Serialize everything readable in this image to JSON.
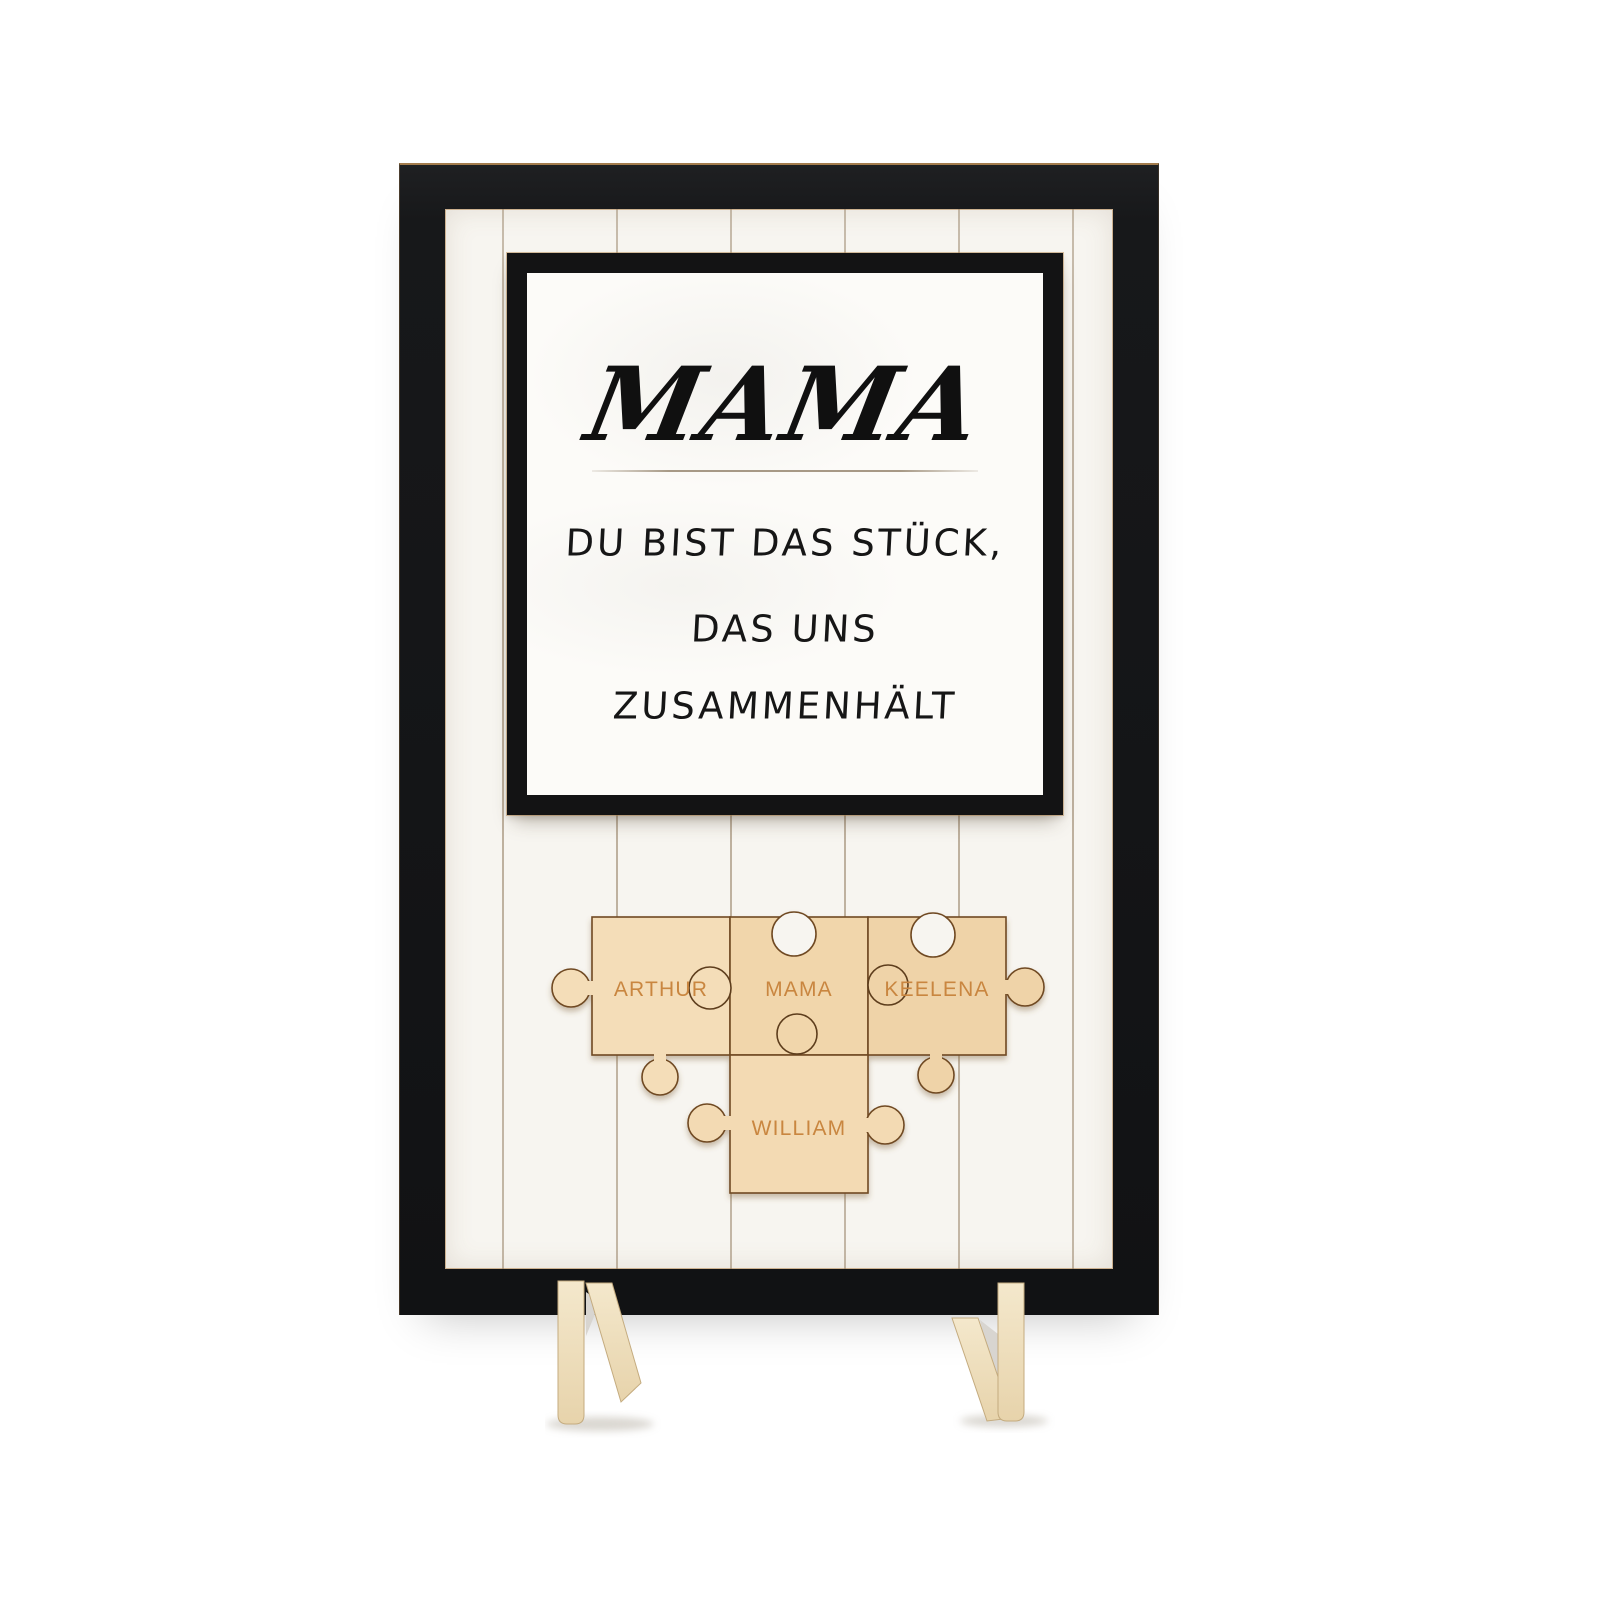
{
  "sign": {
    "title": "MAMA",
    "message_lines": [
      "DU BIST DAS STÜCK,",
      "DAS UNS",
      "ZUSAMMENHÄLT"
    ]
  },
  "puzzle": {
    "pieces": [
      {
        "name": "ARTHUR"
      },
      {
        "name": "MAMA"
      },
      {
        "name": "KEELENA"
      },
      {
        "name": "WILLIAM"
      }
    ]
  },
  "colors": {
    "frame_black": "#17181a",
    "panel_white": "#f7f5f0",
    "card_white": "#fcfbf8",
    "wood_light": "#f2d9ae",
    "wood_outline": "#6f4a24",
    "engraving": "#c9863f",
    "plywood_edge": "#b98a52",
    "plank_line": "#94826a",
    "foot_wood": "#eee0c0"
  }
}
